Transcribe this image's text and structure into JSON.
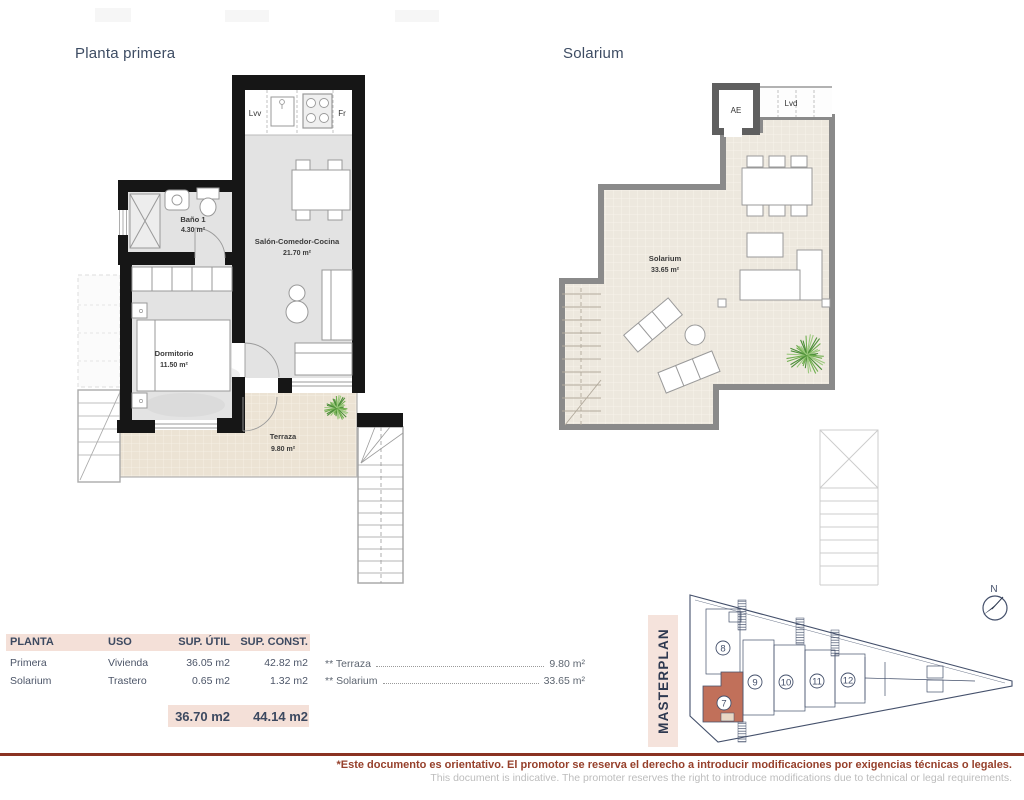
{
  "titles": {
    "plan1": "Planta primera",
    "plan2": "Solarium"
  },
  "plan1": {
    "kitchen": {
      "dishwasher": "Lvv",
      "fridge": "Fr"
    },
    "rooms": [
      {
        "name": "Baño 1",
        "area": "4.30 m²"
      },
      {
        "name": "Salón-Comedor-Cocina",
        "area": "21.70 m²"
      },
      {
        "name": "Dormitorio",
        "area": "11.50 m²"
      },
      {
        "name": "Terraza",
        "area": "9.80 m²"
      }
    ]
  },
  "plan2": {
    "labels": {
      "elevator": "AE",
      "laundry": "Lvd"
    },
    "rooms": [
      {
        "name": "Solarium",
        "area": "33.65 m²"
      }
    ]
  },
  "areas_table": {
    "headers": [
      "PLANTA",
      "USO",
      "SUP. ÚTIL",
      "SUP. CONST."
    ],
    "rows": [
      {
        "planta": "Primera",
        "uso": "Vivienda",
        "sup_util": "36.05 m2",
        "sup_const": "42.82 m2"
      },
      {
        "planta": "Solarium",
        "uso": "Trastero",
        "sup_util": "0.65 m2",
        "sup_const": "1.32 m2"
      }
    ],
    "total_util": "36.70 m2",
    "total_const": "44.14 m2"
  },
  "annotations": [
    {
      "label": "** Terraza",
      "value": "9.80 m²"
    },
    {
      "label": "** Solarium",
      "value": "33.65 m²"
    }
  ],
  "masterplan": {
    "title": "MASTERPLAN",
    "compass_label": "N",
    "units": [
      {
        "number": "7",
        "highlighted": true
      },
      {
        "number": "8"
      },
      {
        "number": "9"
      },
      {
        "number": "10"
      },
      {
        "number": "11"
      },
      {
        "number": "12"
      }
    ]
  },
  "footer": {
    "disclaimer_es": "*Este documento es orientativo. El promotor se reserva el derecho a introducir modificaciones por exigencias técnicas o legales.",
    "disclaimer_en": "This document is indicative. The promoter reserves the right to introduce modifications due to technical or legal requirements."
  },
  "colors": {
    "accent_pink": "#f4e0d8",
    "navy": "#3c4960",
    "wall_black": "#161616",
    "wall_gray": "#8a8a8a",
    "terrace_beige": "#ece3d4",
    "interior_gray": "#e3e3e3",
    "highlight_unit": "#c1705a",
    "footer_red": "#8a3222",
    "plant_green": "#6fae4e"
  }
}
